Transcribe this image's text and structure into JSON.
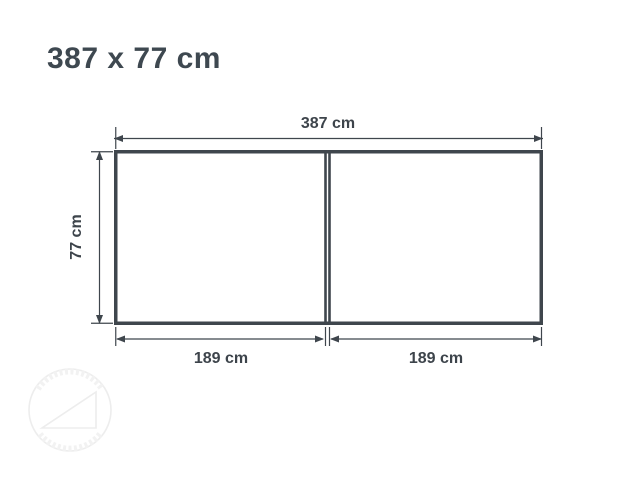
{
  "title": "387 x 77 cm",
  "diagram": {
    "width_label": "387 cm",
    "height_label": "77 cm",
    "sections": [
      {
        "label": "189 cm"
      },
      {
        "label": "189 cm"
      }
    ]
  },
  "colors": {
    "background": "#ffffff",
    "outline": "#3f464d",
    "dimension_line": "#3f464d",
    "title_text": "#3e4850",
    "dimension_text": "#3d444b",
    "watermark": "#ededed"
  },
  "watermark": {
    "icon": "circular-stamp-logo"
  }
}
